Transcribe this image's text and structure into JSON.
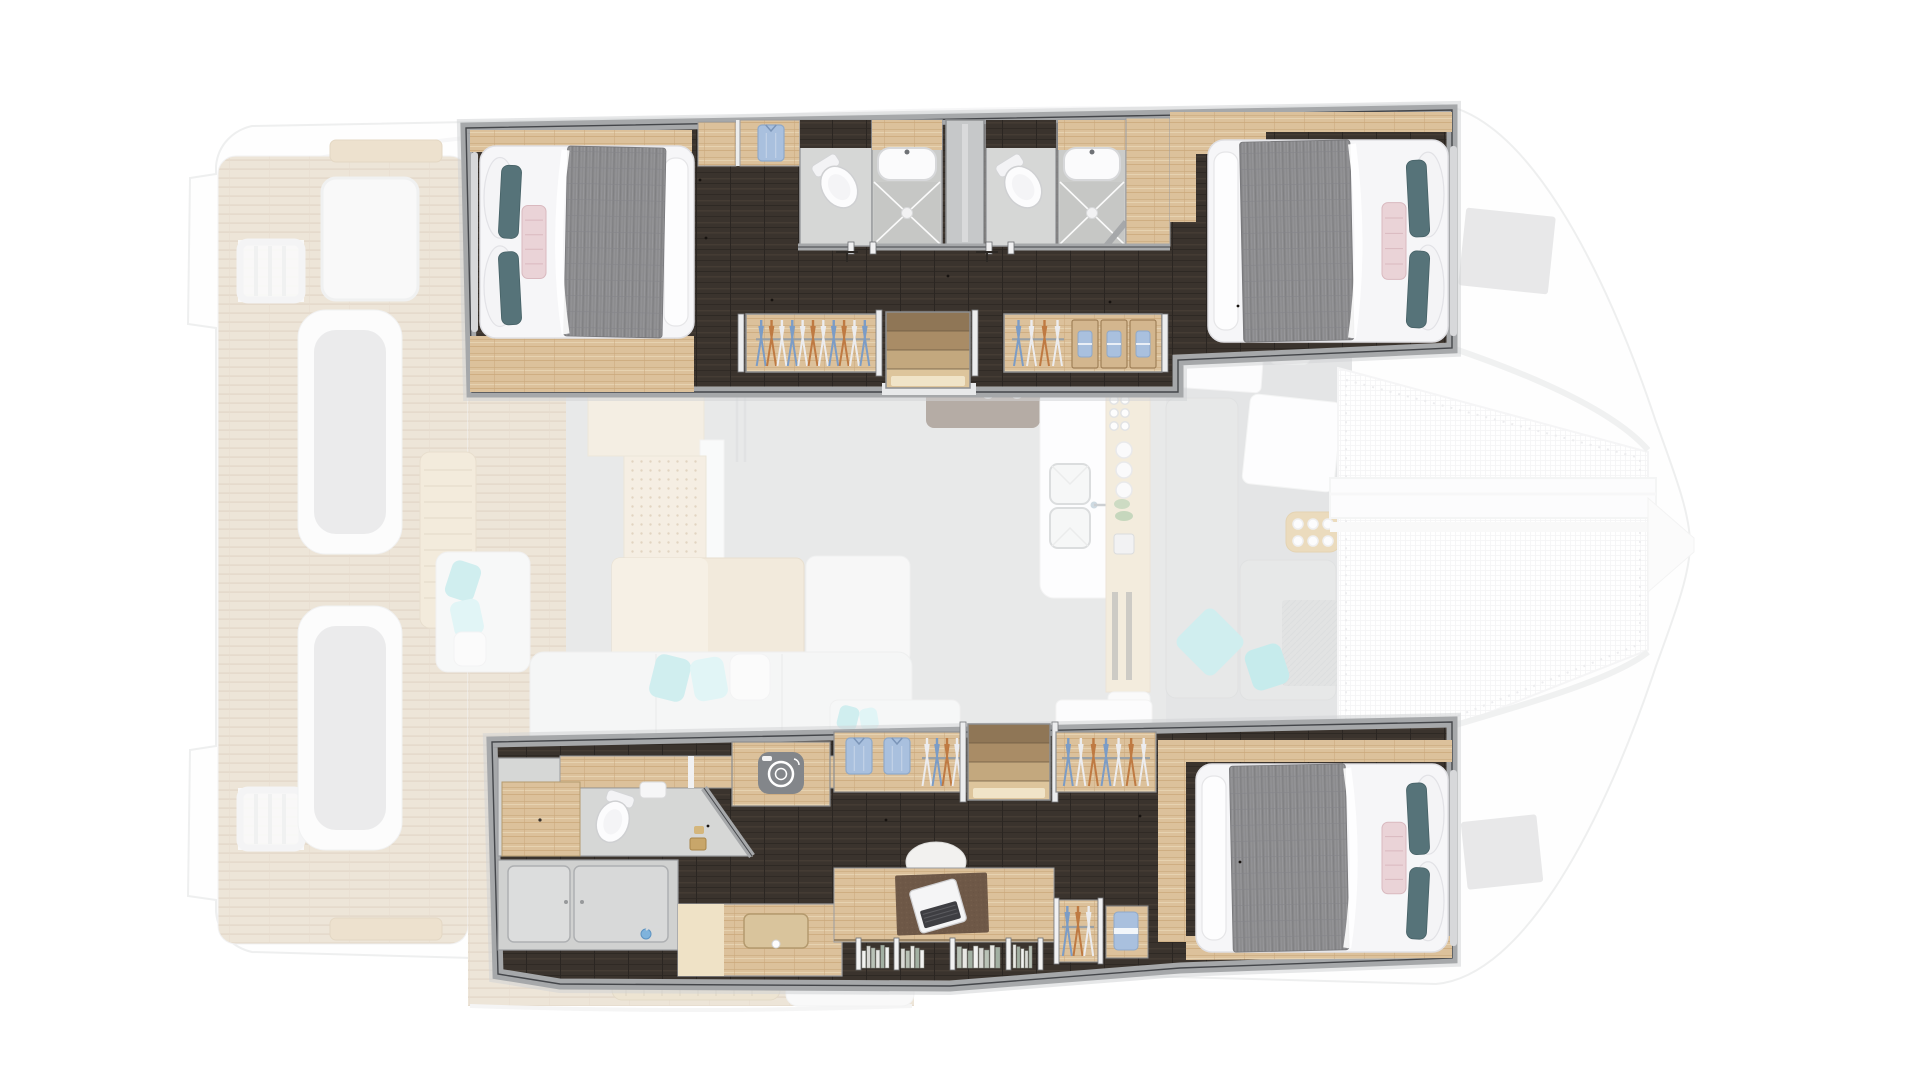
{
  "meta": {
    "title": "Catamaran yacht interior floor plan — 4-cabin top-down layout",
    "view": "top-down render",
    "text_on_image": "none"
  },
  "palette": {
    "page_bg": "#ffffff",
    "hull_line": "#dfe0e1",
    "wall_band": "#a6a8aa",
    "wall_dark": "#44464a",
    "wall_shadow": "#d2d3d5",
    "walnut_floor": "#3a332d",
    "oak_wood": "#dcc19b",
    "teak_deck": "#ddccb3",
    "bath_floor": "#d6d7d6",
    "shower_floor": "#c6c7c5",
    "sliding_door_gray": "#c6c8c9",
    "porcelain": "#fcfcfd",
    "salon_floor": "#d3d4d5",
    "fore_floor": "#cbcdce",
    "sofa_white": "#edefef",
    "seat_gray": "#d0d2d3",
    "blanket_gray": "#8b8b8d",
    "duvet_white": "#f6f6f8",
    "pillow_teal": "#567379",
    "pillow_pink": "#ead3d7",
    "pillow_pink_line": "#d9b9bf",
    "aqua_pillow": "#a3dfe1",
    "aqua_pillow_soft": "#c5ecee",
    "hanger_blue": "#7b9cc6",
    "hanger_orange": "#bf7a42",
    "hanger_white": "#ececee",
    "hanger_rail": "#9aa0a4",
    "shirt_blue": "#a9c0de",
    "shirt_blue_dark": "#8fa9c9",
    "stair_1": "#8f7656",
    "stair_2": "#a98c66",
    "stair_3": "#c3a87e",
    "stair_4": "#ddc59c",
    "stair_glow": "#f2e7cd",
    "desk_mat_brown": "#6e5847",
    "laptop_keys": "#3e3e42",
    "laundry_icon_gray": "#83868a",
    "hatch_gray": "#d2d3d4",
    "net_line": "#ededef",
    "gold_accessory": "#c8a66a",
    "table_wood": "#e7d7ba",
    "tray_wood": "#d9b97e"
  },
  "wardrobes": {
    "top_closet": {
      "folded_shirts": 1
    },
    "top_left": {
      "hangers": [
        "#7b9cc6",
        "#bf7a42",
        "#ececee",
        "#7b9cc6",
        "#ececee",
        "#bf7a42",
        "#ececee",
        "#7b9cc6",
        "#bf7a42",
        "#ececee",
        "#7b9cc6"
      ]
    },
    "top_right": {
      "hangers": [
        "#7b9cc6",
        "#ececee",
        "#bf7a42",
        "#ececee"
      ],
      "drawers_with_folded_clothes": 3
    },
    "bottom_left": {
      "folded_shirts": 2,
      "hangers": [
        "#ececee",
        "#7b9cc6",
        "#bf7a42",
        "#ececee"
      ]
    },
    "bottom_right": {
      "hangers": [
        "#7b9cc6",
        "#ececee",
        "#bf7a42",
        "#7b9cc6",
        "#ececee",
        "#bf7a42",
        "#ececee"
      ]
    },
    "office_locker": {
      "hangers": [
        "#7b9cc6",
        "#bf7a42",
        "#ececee"
      ]
    }
  },
  "stairs": {
    "top_hull": {
      "treads": 4
    },
    "bottom_hull": {
      "treads": 4
    }
  },
  "galley": {
    "bottles": 6,
    "plates": 3,
    "cups_on_tray": 6,
    "bar_stools": 4,
    "sinks": 2
  },
  "office": {
    "book_groups": [
      6,
      5,
      8,
      5
    ],
    "laptops": 1
  },
  "fixtures": {
    "double_berths": 3,
    "toilets": 3,
    "showers": 3,
    "washbasins": 3,
    "washing_machine_icons": 1
  }
}
